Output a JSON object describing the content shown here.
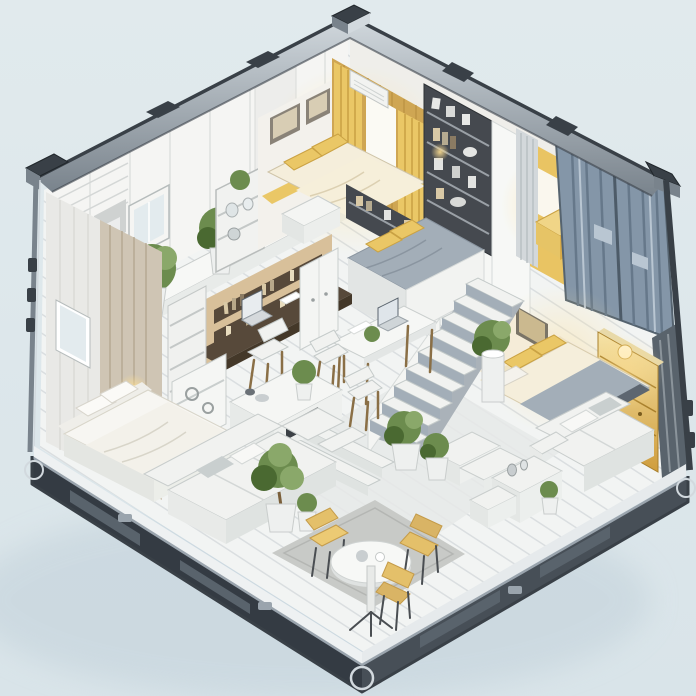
{
  "meta": {
    "description": "Isometric cutaway illustration of a shipping-container tiny home: open metal container shell with corrugated blue doors, holding a gold-lit master bedroom, reading nook, loft bedroom with staircase, guest bedroom with lit wardrobe, desk nook with laptop, dining table, sectional sofa living area, cafe corner with round table and yellow chairs, and many potted plants on a white plank floor."
  },
  "palette": {
    "bg_top": "#e1eaed",
    "bg_bottom": "#d9e4e9",
    "shadow": "#c2d1da",
    "metal_dark": "#394047",
    "metal_mid": "#79838c",
    "metal_light": "#d2d9de",
    "rail_dark": "#343b43",
    "rail_mid": "#59636c",
    "rail_light": "#9aa4ad",
    "wall_white": "#f5f5f3",
    "wall_soft": "#eceded",
    "wall_shade": "#dfe1e0",
    "wall_dark": "#cfd2d1",
    "floor": "#f2f4f3",
    "floor_line": "#c6ccd0",
    "floor_shade": "#e6e9e8",
    "rug": "#c8cac7",
    "rug_dark": "#b4b6b3",
    "wood_warm": "#cfa653",
    "wood_light": "#e3c077",
    "wood_dark": "#9c7832",
    "wood_desk": "#57493a",
    "wood_desk_dark": "#443829",
    "wood_leg": "#8a6f46",
    "gold": "#eac766",
    "gold_light": "#f6e3a6",
    "gold_deep": "#cf9d3d",
    "glow": "#ffdf92",
    "cream": "#f5eedb",
    "cream_dark": "#ddd2b4",
    "gray_bed": "#a3aeb8",
    "gray_bed_dark": "#5d6670",
    "door_blue": "#8496a8",
    "door_blue_dark": "#5c6a78",
    "door_blue_light": "#b9c6d2",
    "plant": "#6c8c4e",
    "plant_dark": "#4a6931",
    "plant_light": "#8aa86a",
    "pot": "#eef0ef",
    "trunk": "#7a5f3a",
    "shelf_dark": "#45494f",
    "book": "#d9c9a6",
    "chair_yellow": "#e4c06a",
    "chair_yellow_dark": "#c49b4a",
    "sofa": "#f1f2f0",
    "sofa_shade": "#dfe3e1",
    "sofa_dark": "#c9cfcf",
    "glass": "#e3ebee",
    "beige_wall": "#d8c09a",
    "slat_wall": "#cfc5b4"
  },
  "scene": {
    "structure": [
      "shipping-container shell",
      "metal corner castings",
      "twist-lock fittings",
      "corrugated blue container doors",
      "dark base rails",
      "white plank floor"
    ],
    "rooms": [
      {
        "name": "master-bedroom",
        "features": [
          "double bed with cream duvet",
          "gold pillows",
          "two framed pictures",
          "gold curtains",
          "window blind",
          "air conditioner",
          "storage cube"
        ]
      },
      {
        "name": "reading-nook",
        "features": [
          "dark bookshelf with mugs and books",
          "gold bench",
          "gray curtain",
          "gold curtain"
        ]
      },
      {
        "name": "loft-bedroom",
        "features": [
          "platform bed with gray duvet",
          "gold pillows",
          "bookshelf headboard",
          "staircase"
        ]
      },
      {
        "name": "guest-bedroom",
        "features": [
          "daybed with gray blanket",
          "framed art",
          "plant pedestal",
          "gold-lit wardrobe with lamp"
        ]
      },
      {
        "name": "study-nook",
        "features": [
          "built-in dark desk",
          "laptop",
          "book shelves",
          "white chair",
          "ladder shelf",
          "console with ornaments"
        ]
      },
      {
        "name": "dining-area",
        "features": [
          "white table",
          "laptop",
          "papers",
          "potted plant",
          "two white chairs"
        ]
      },
      {
        "name": "living-area",
        "features": [
          "single bed with white duvet",
          "wall lamp",
          "window",
          "sectional sofa",
          "coffee table with plant",
          "potted tree"
        ]
      },
      {
        "name": "cafe-corner",
        "features": [
          "gray rug",
          "round white table",
          "three yellow chairs",
          "two potted plants"
        ]
      },
      {
        "name": "lounge-corner",
        "features": [
          "white sofa with cushions",
          "side cabinets with jars",
          "small plant",
          "shrub planters",
          "low white steps"
        ]
      }
    ]
  }
}
